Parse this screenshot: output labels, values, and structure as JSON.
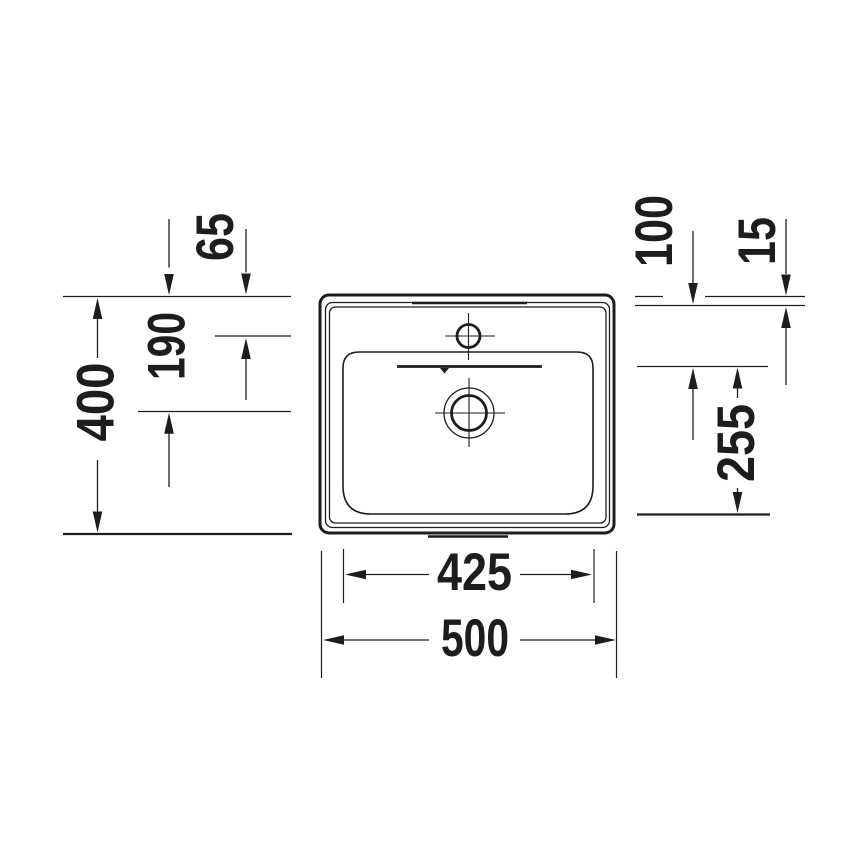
{
  "background_color": "#ffffff",
  "line_color": "#1d1d1b",
  "drawing": {
    "subject": "washbasin-top-view"
  },
  "dimensions": {
    "left": [
      {
        "name": "faucet-hole-from-rear",
        "value": "65"
      },
      {
        "name": "drain-center-from-rear",
        "value": "190"
      },
      {
        "name": "overall-depth",
        "value": "400"
      }
    ],
    "right": [
      {
        "name": "rear-ledge-to-overflow-line",
        "value": "100"
      },
      {
        "name": "rear-rim-width",
        "value": "15"
      },
      {
        "name": "overflow-line-to-bowl-front",
        "value": "255"
      }
    ],
    "bottom": [
      {
        "name": "bowl-width",
        "value": "425"
      },
      {
        "name": "overall-width",
        "value": "500"
      }
    ]
  }
}
